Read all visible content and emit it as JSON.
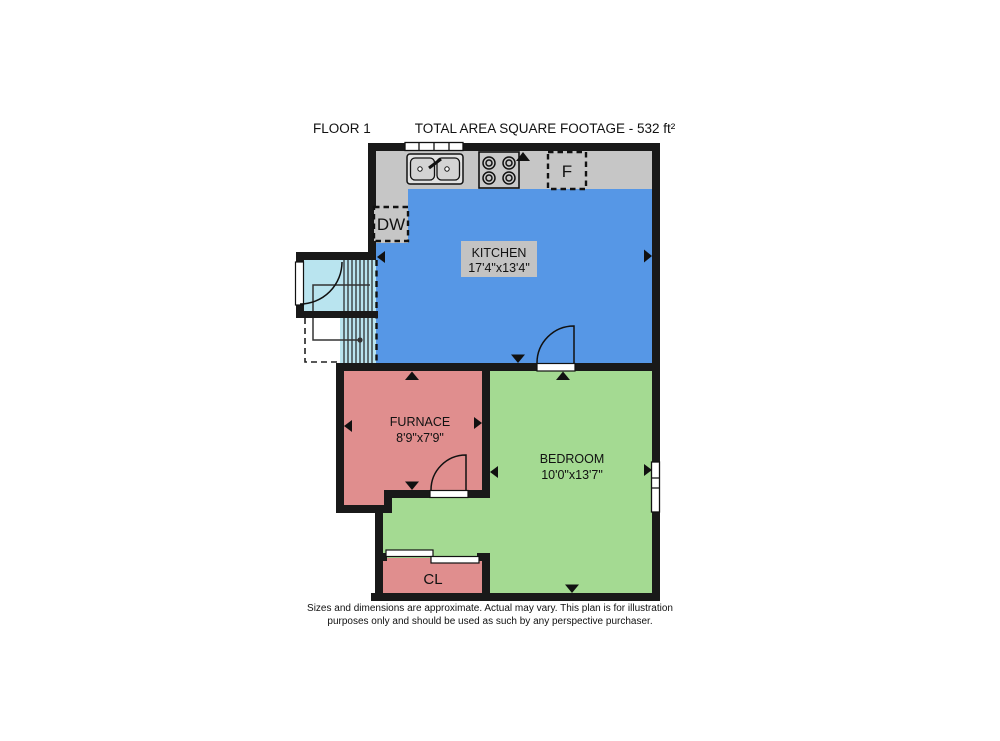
{
  "header": {
    "floor_label": "FLOOR 1",
    "total_area": "TOTAL AREA SQUARE FOOTAGE - 532 ft²"
  },
  "rooms": {
    "kitchen": {
      "name": "KITCHEN",
      "dimensions": "17'4\"x13'4\""
    },
    "furnace": {
      "name": "FURNACE",
      "dimensions": "8'9\"x7'9\""
    },
    "bedroom": {
      "name": "BEDROOM",
      "dimensions": "10'0\"x13'7\""
    },
    "closet": {
      "name": "CL"
    }
  },
  "appliances": {
    "dishwasher_label": "DW",
    "fridge_label": "F"
  },
  "disclaimer": {
    "line1": "Sizes and dimensions are approximate. Actual may vary. This plan is for illustration",
    "line2": "purposes only and should be used as such by any perspective purchaser."
  },
  "colors": {
    "wall": "#191919",
    "kitchen": "#5697e6",
    "counter": "#c6c6c6",
    "label_box": "#c3c3c3",
    "furnace": "#e08e8e",
    "bedroom": "#a4da92",
    "stairs": "#b9e4ef",
    "white": "#ffffff"
  }
}
